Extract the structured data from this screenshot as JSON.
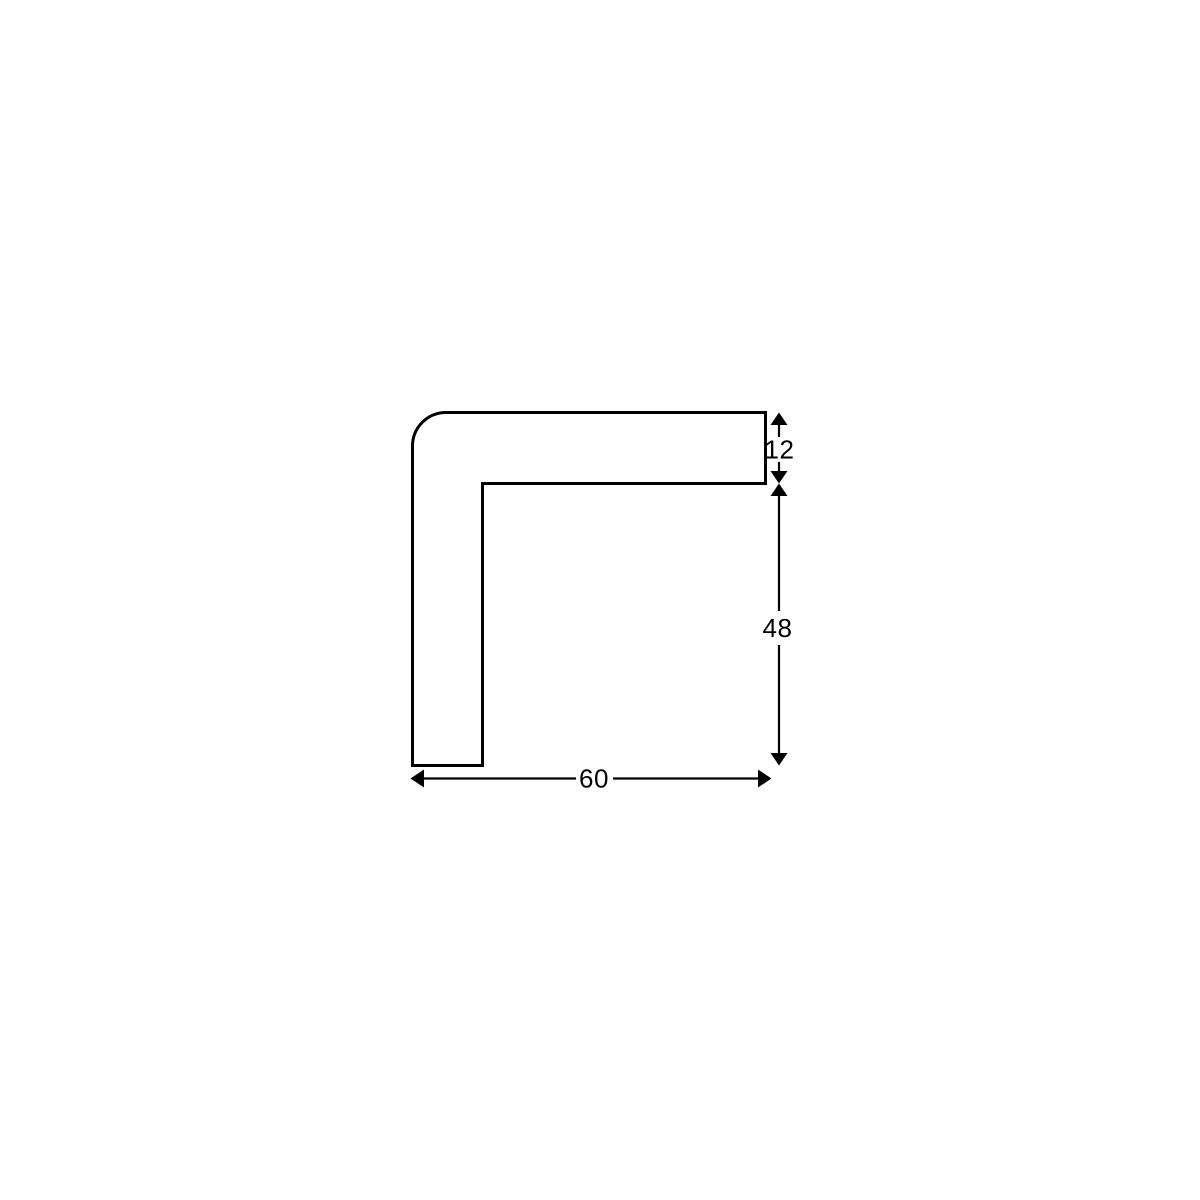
{
  "diagram": {
    "background_color": "#ffffff",
    "line_color": "#000000",
    "labels": {
      "thickness": "12",
      "height": "48",
      "width": "60"
    }
  }
}
